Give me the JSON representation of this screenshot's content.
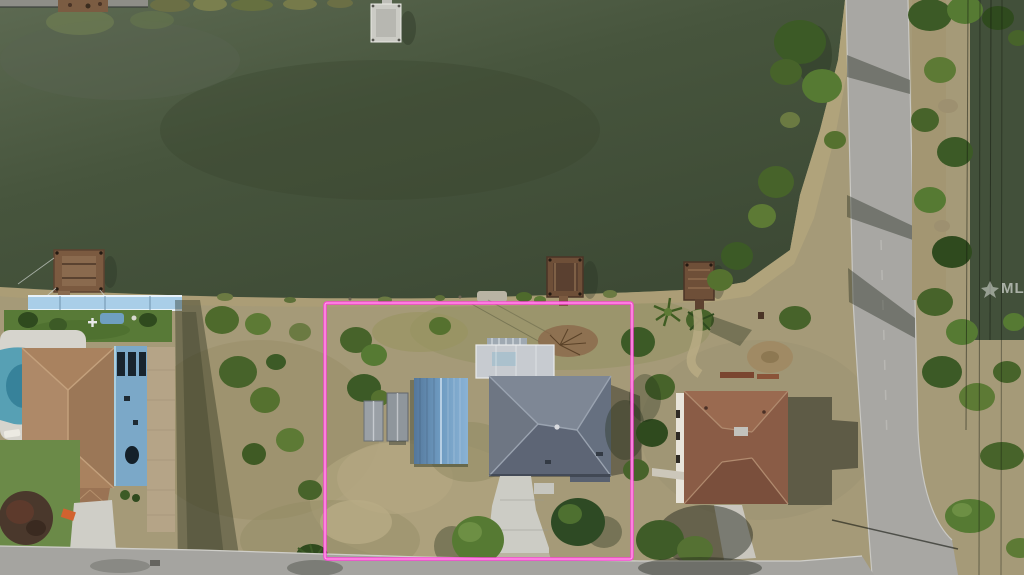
{
  "photo": {
    "kind": "aerial-drone-photo",
    "subject": "waterfront residential lot outlined in pink"
  },
  "watermark": {
    "text": "MLS",
    "color": "rgba(255,255,255,0.55)"
  },
  "boundary": {
    "x": 325,
    "y": 303,
    "width": 307,
    "height": 256,
    "color": "#ff3fd8",
    "inner_color": "#ffc0ee"
  },
  "palette": {
    "canal_water": "#47553d",
    "water_light": "#5d6a52",
    "scrub_land": "#a59a78",
    "road_asphalt": "#a8a7a3",
    "turf_green": "#587a37",
    "subject_roof_gray": "#6e7683",
    "garage_roof_blue": "#6f9cc2",
    "left_roof_tan": "#a9825f",
    "left_deck_blue": "#7ba8c8",
    "right_roof_brown": "#8a5c46",
    "pool_water": "#57a0b4",
    "dock_wood": "#6e4f38"
  },
  "scene": {
    "docks_count": 5,
    "outbuildings_on_lot": [
      "blue-metal-garage",
      "shed-1",
      "shed-2"
    ],
    "neighbors": [
      "left-house-with-pool",
      "right-brown-roof-house"
    ]
  }
}
